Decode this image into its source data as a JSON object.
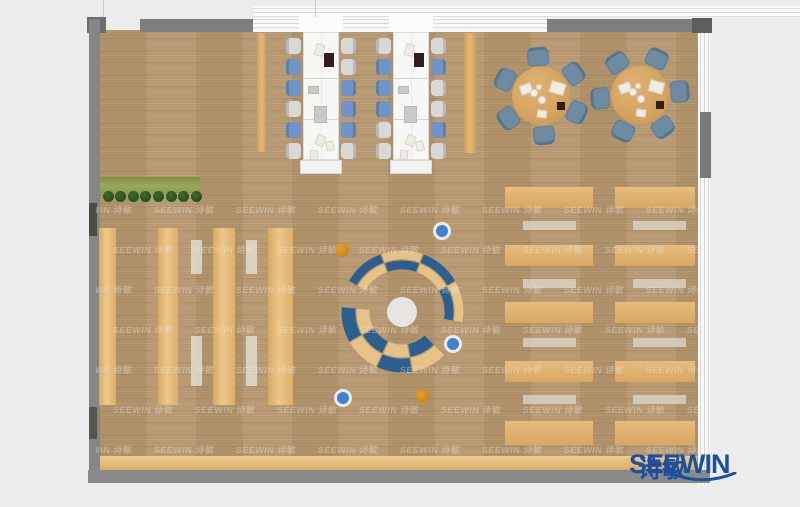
{
  "brand": {
    "logo_text": "SEEWIN",
    "logo_text_cn": "诗敏",
    "logo_color": "#1c4fa0",
    "watermark_text": "SEEWIN 诗敏"
  },
  "palette": {
    "outside": "#ececec",
    "wall": "#828282",
    "wall_dark": "#5e5e5e",
    "floor": "#b4956d",
    "desk_white": "#f7f7f6",
    "chair_gray": "#d8d9d6",
    "chair_blue": "#6f94c5",
    "table_tan": "#d8a764",
    "table_chair": "#6d8ca4",
    "shelf_tan": "#e5ba77",
    "strip_light": "#d9d2c5",
    "row_tan": "#dfb274",
    "row_gray": "#cdc5b8",
    "planter_green": "#93a254",
    "plant_dark": "#2b5a22",
    "bench_tan": "#e0b678",
    "arc_blue": "#2c5f8e",
    "arc_tan": "#e6c288",
    "circle_white": "#e6e5e3",
    "stool_orange": "#d2891c",
    "stool_blue": "#4182cb",
    "logo_blue": "#1c4fa0"
  },
  "plan": {
    "canvas": {
      "w": 800,
      "h": 507
    },
    "floor": {
      "x": 100,
      "y": 30,
      "w": 598,
      "h": 440
    },
    "walls": [
      {
        "x": 87,
        "y": 17,
        "w": 19,
        "h": 16,
        "c": "#6d6d6d"
      },
      {
        "x": 89,
        "y": 19,
        "w": 11,
        "h": 464,
        "c": "#858585"
      },
      {
        "x": 140,
        "y": 19,
        "w": 113,
        "h": 13,
        "c": "#7e7e7e"
      },
      {
        "x": 547,
        "y": 19,
        "w": 151,
        "h": 13,
        "c": "#7e7e7e"
      },
      {
        "x": 692,
        "y": 18,
        "w": 20,
        "h": 15,
        "c": "#5e5e5e"
      },
      {
        "x": 88,
        "y": 470,
        "w": 622,
        "h": 13,
        "c": "#8a8a8a"
      },
      {
        "x": 89,
        "y": 203,
        "w": 8,
        "h": 33,
        "c": "#4c4c45"
      },
      {
        "x": 89,
        "y": 407,
        "w": 8,
        "h": 32,
        "c": "#55554e"
      },
      {
        "x": 700,
        "y": 112,
        "w": 11,
        "h": 66,
        "c": "#7a7a7a"
      }
    ],
    "bands": {
      "top_outer": {
        "x": 253,
        "y": 6,
        "w": 547,
        "h": 12
      },
      "top_inner": {
        "x": 253,
        "y": 17,
        "w": 294,
        "h": 15
      },
      "right": {
        "x": 698,
        "y": 30,
        "w": 13,
        "h": 455
      },
      "desk_gaps": [
        {
          "x": 299,
          "y": 16,
          "w": 44,
          "h": 16
        },
        {
          "x": 389,
          "y": 16,
          "w": 44,
          "h": 16
        }
      ],
      "lines_above": [
        {
          "x": 103,
          "y": 0,
          "h": 19
        },
        {
          "x": 315,
          "y": 0,
          "h": 17
        }
      ]
    },
    "planter": {
      "bench": {
        "x": 100,
        "y": 177,
        "w": 100,
        "h": 16
      },
      "plants_y": 196,
      "plants_x0": 108,
      "plants_dx": 12.6,
      "plants_n": 8,
      "plant_r": 5.5
    },
    "planks": [
      {
        "x": 257,
        "y": 33,
        "w": 9,
        "h": 119
      },
      {
        "x": 464,
        "y": 33,
        "w": 12,
        "h": 120
      }
    ],
    "workstations": {
      "desk_y": 32,
      "desk_h": 128,
      "cap_h": 14,
      "chair_w": 15,
      "chair_h": 16,
      "chair_ys": [
        38,
        59,
        80,
        101,
        122,
        143
      ],
      "divider_ys": [
        78,
        119
      ],
      "rows": [
        {
          "desk_x": 303,
          "desk_w": 36,
          "left": [
            "g",
            "b",
            "b",
            "g",
            "b",
            "g"
          ],
          "right": [
            "g",
            "g",
            "b",
            "b",
            "b",
            "g"
          ]
        },
        {
          "desk_x": 393,
          "desk_w": 36,
          "left": [
            "g",
            "b",
            "b",
            "b",
            "g",
            "g"
          ],
          "right": [
            "g",
            "b",
            "g",
            "g",
            "b",
            "g"
          ]
        }
      ],
      "items": [
        {
          "dx": 12,
          "y": 44,
          "w": 9,
          "h": 12,
          "t": "paper",
          "rot": 14
        },
        {
          "dx": 21,
          "y": 53,
          "w": 10,
          "h": 14,
          "t": "dark",
          "rot": 0
        },
        {
          "dx": 5,
          "y": 86,
          "w": 11,
          "h": 8,
          "t": "pad",
          "rot": 0
        },
        {
          "dx": 11,
          "y": 106,
          "w": 13,
          "h": 17,
          "t": "pad",
          "rot": 0
        },
        {
          "dx": 13,
          "y": 135,
          "w": 9,
          "h": 11,
          "t": "paper",
          "rot": 22
        },
        {
          "dx": 23,
          "y": 141,
          "w": 8,
          "h": 10,
          "t": "paper",
          "rot": -14
        },
        {
          "dx": 7,
          "y": 150,
          "w": 8,
          "h": 10,
          "t": "paper",
          "rot": 6
        }
      ]
    },
    "round_tables": {
      "r": 29,
      "chair_dist": 40,
      "chair_w": 22,
      "chair_h": 19,
      "tables": [
        {
          "cx": 541,
          "cy": 96,
          "angles": [
            95,
            155,
            215,
            275,
            335,
            35
          ]
        },
        {
          "cx": 640,
          "cy": 95,
          "angles": [
            65,
            125,
            185,
            245,
            305,
            5
          ]
        }
      ],
      "items": [
        {
          "t": "paper",
          "dx": -21,
          "dy": -12,
          "w": 12,
          "h": 10,
          "rot": -20
        },
        {
          "t": "paper",
          "dx": 9,
          "dy": -14,
          "w": 15,
          "h": 12,
          "rot": 16
        },
        {
          "t": "dark",
          "dx": 16,
          "dy": 6,
          "w": 8,
          "h": 8,
          "rot": 0
        },
        {
          "t": "paper",
          "dx": -4,
          "dy": 14,
          "w": 10,
          "h": 8,
          "rot": 8
        },
        {
          "t": "plate",
          "dx": -7,
          "dy": -3,
          "r": 4
        },
        {
          "t": "plate",
          "dx": 1,
          "dy": 4,
          "r": 4
        },
        {
          "t": "plate",
          "dx": -2,
          "dy": -9,
          "r": 3
        }
      ]
    },
    "shelves": {
      "y": 228,
      "h": 177,
      "cols": [
        {
          "x": 99,
          "w": 17
        },
        {
          "x": 158,
          "w": 20
        },
        {
          "x": 213,
          "w": 22
        },
        {
          "x": 268,
          "w": 25
        }
      ],
      "strips": {
        "xs": [
          191,
          246
        ],
        "w": 11,
        "segs": [
          {
            "y": 240,
            "h": 34
          },
          {
            "y": 336,
            "h": 50
          }
        ]
      }
    },
    "right_rows": {
      "cols": [
        {
          "x": 505,
          "w": 88,
          "strip_x": 523
        },
        {
          "x": 615,
          "w": 80,
          "strip_x": 633
        }
      ],
      "strip_w": 53,
      "tan_ys": [
        187,
        245,
        302,
        361,
        421
      ],
      "tan_h": 21,
      "tan_last_h": 24,
      "strip_ys": [
        221,
        279,
        338,
        395
      ],
      "strip_h": 9
    },
    "bench_bottom": {
      "x": 100,
      "y": 456,
      "w": 597,
      "h": 14
    },
    "lounge": {
      "cx": 402,
      "cy": 312,
      "circle_r": 15,
      "upper": {
        "a0": -10,
        "a1": 150,
        "segs": 4,
        "r_in": 42,
        "r_mid": 52,
        "r_out": 62,
        "outer": [
          "tan",
          "blue",
          "tan",
          "blue"
        ],
        "inner": [
          "blue",
          "tan",
          "blue",
          "tan"
        ]
      },
      "lower": {
        "a0": 175,
        "a1": 315,
        "segs": 4,
        "r_in": 32,
        "r_mid": 46,
        "r_out": 61,
        "outer": [
          "blue",
          "tan",
          "blue",
          "tan"
        ],
        "inner": [
          "tan",
          "blue",
          "tan",
          "blue"
        ]
      }
    },
    "stools": [
      {
        "x": 342,
        "y": 250,
        "c": "orange"
      },
      {
        "x": 442,
        "y": 231,
        "c": "blue"
      },
      {
        "x": 453,
        "y": 344,
        "c": "blue"
      },
      {
        "x": 343,
        "y": 398,
        "c": "blue"
      },
      {
        "x": 422,
        "y": 396,
        "c": "orange"
      }
    ],
    "watermark": {
      "x": 96,
      "y": 198,
      "w": 606,
      "h": 262,
      "row_dy": 40,
      "col_dx": 82,
      "stagger": 41,
      "rows": 7,
      "cols": 9
    }
  }
}
